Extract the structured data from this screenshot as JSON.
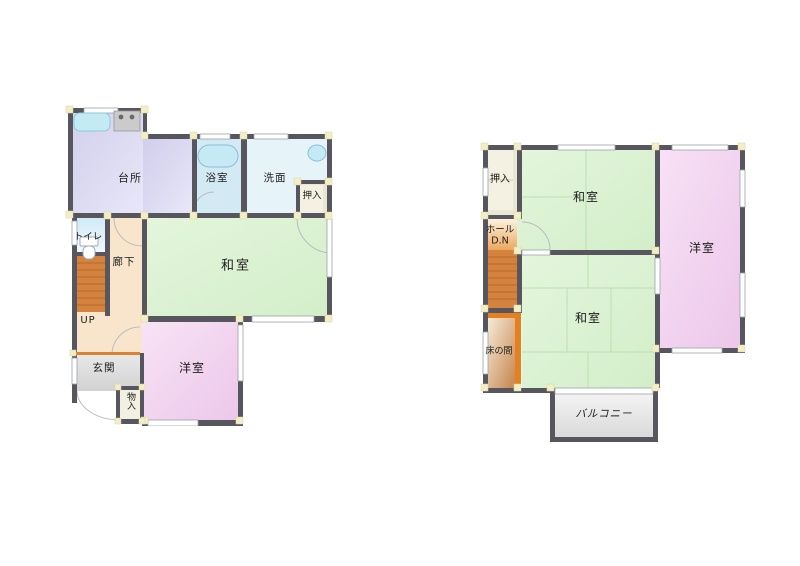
{
  "figure": "japanese-house-floor-plan",
  "floor1": {
    "rooms": {
      "kitchen": "台所",
      "bathroom": "浴室",
      "washroom": "洗面",
      "closet": "押入",
      "toilet": "トイレ",
      "hallway": "廊下",
      "tatami_room": "和室",
      "stairs_label": "UP",
      "entrance": "玄関",
      "storage": "物入",
      "western_room": "洋室"
    }
  },
  "floor2": {
    "rooms": {
      "closet": "押入",
      "tatami_room_north": "和室",
      "western_room": "洋室",
      "hall": "ホール",
      "stairs_label": "D.N",
      "tokonoma": "床の間",
      "tatami_room_south": "和室",
      "balcony": "バルコニー"
    }
  },
  "colors": {
    "wall": "#57565e",
    "tatami_green": "#ddf2d4",
    "western_pink": "#f2d5ef",
    "kitchen_lavender": "#d8d6f0",
    "bath_blue": "#d3e9f3",
    "washroom_blue": "#e6f3f9",
    "hallway_peach": "#f8e5cb",
    "stairs_orange": "#d5823e",
    "entrance_gray": "#dedede",
    "closet_beige": "#eae6d4",
    "pillar_yellow": "#f2eec6",
    "tokonoma_orange": "#e6801f",
    "balcony_gray": "#e9e9e9"
  }
}
